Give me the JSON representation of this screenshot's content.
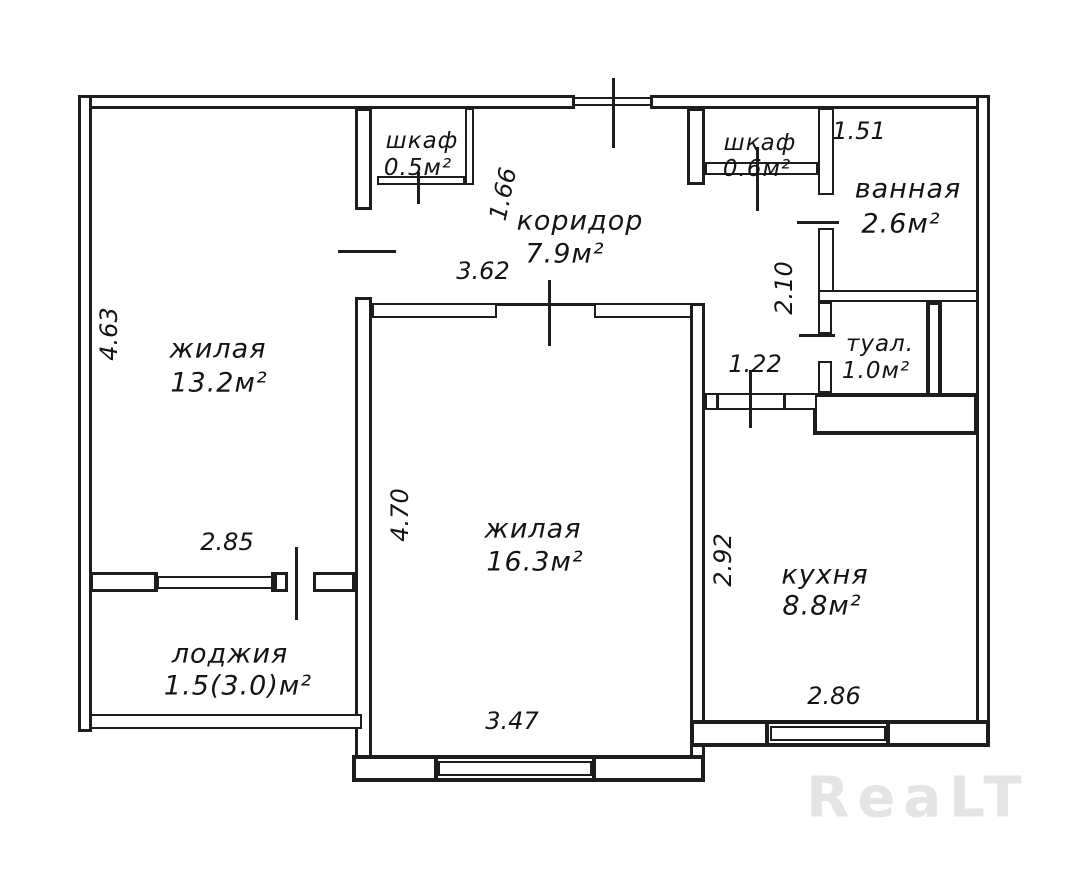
{
  "rooms": {
    "living1": {
      "name": "жилая",
      "area": "13.2м²"
    },
    "living2": {
      "name": "жилая",
      "area": "16.3м²"
    },
    "corridor": {
      "name": "коридор",
      "area": "7.9м²"
    },
    "closet1": {
      "name": "шкаф",
      "area": "0.5м²"
    },
    "closet2": {
      "name": "шкаф",
      "area": "0.6м²"
    },
    "bathroom": {
      "name": "ванная",
      "area": "2.6м²"
    },
    "toilet": {
      "name": "туал.",
      "area": "1.0м²"
    },
    "kitchen": {
      "name": "кухня",
      "area": "8.8м²"
    },
    "loggia": {
      "name": "лоджия",
      "area": "1.5(3.0)м²"
    }
  },
  "dimensions": {
    "d463": "4.63",
    "d285": "2.85",
    "d166": "1.66",
    "d362": "3.62",
    "d470": "4.70",
    "d347": "3.47",
    "d151": "1.51",
    "d210": "2.10",
    "d122": "1.22",
    "d292": "2.92",
    "d286": "2.86"
  },
  "watermark": "ReaLT",
  "colors": {
    "line": "#1d1d1d",
    "watermark": "#e4e4e4",
    "background": "#ffffff"
  }
}
